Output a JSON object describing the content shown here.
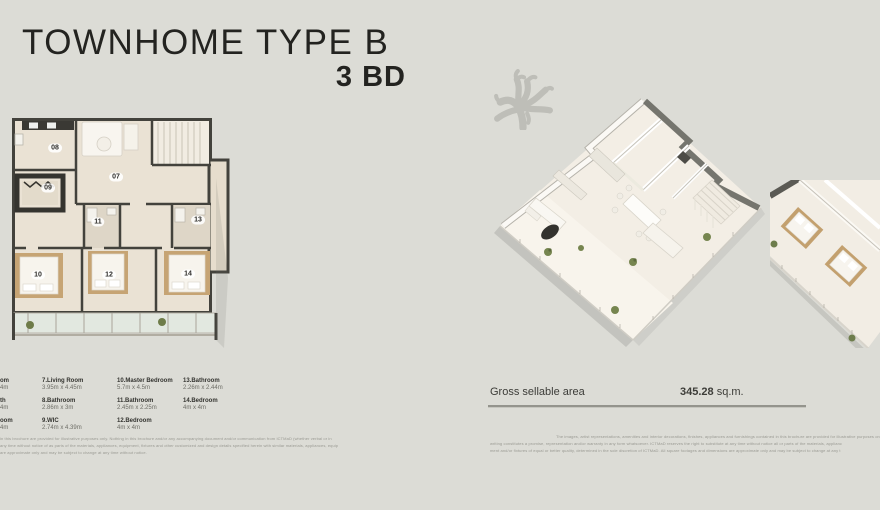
{
  "title": {
    "line1": "TOWNHOME TYPE B",
    "line2": "3 BD"
  },
  "plan2d": {
    "labels": [
      {
        "n": "08",
        "x": 43,
        "y": 30
      },
      {
        "n": "07",
        "x": 104,
        "y": 59
      },
      {
        "n": "09",
        "x": 36,
        "y": 70
      },
      {
        "n": "11",
        "x": 86,
        "y": 104
      },
      {
        "n": "13",
        "x": 186,
        "y": 102
      },
      {
        "n": "10",
        "x": 26,
        "y": 157
      },
      {
        "n": "12",
        "x": 97,
        "y": 157
      },
      {
        "n": "14",
        "x": 176,
        "y": 156
      }
    ]
  },
  "legend": {
    "col0": [
      {
        "name": "om",
        "dims": "4m"
      },
      {
        "name": "th",
        "dims": "4m"
      },
      {
        "name": "oom",
        "dims": "4m"
      }
    ],
    "col1": [
      {
        "name": "7.Living Room",
        "dims": "3.95m x 4.45m"
      },
      {
        "name": "8.Bathroom",
        "dims": "2.86m x 3m"
      },
      {
        "name": "9.WIC",
        "dims": "2.74m x 4.39m"
      }
    ],
    "col2": [
      {
        "name": "10.Master Bedroom",
        "dims": "5.7m x 4.5m"
      },
      {
        "name": "11.Bathroom",
        "dims": "2.45m x 2.25m"
      },
      {
        "name": "12.Bedroom",
        "dims": "4m x 4m"
      }
    ],
    "col3": [
      {
        "name": "13.Bathroom",
        "dims": "2.26m x 2.44m"
      },
      {
        "name": "14.Bedroom",
        "dims": "4m x 4m"
      }
    ]
  },
  "area": {
    "label": "Gross sellable area",
    "value": "345.28",
    "unit": "sq.m."
  },
  "disclaimer_left": [
    "in this brochure are provided for illustrative purposes only. Nothing in this brochure and/or any accompanying document and/or communication from ICTMaD (whether verbal or in",
    "any time without notice of as parts of the materials, appliances, equipment, fixtures and other customized and design details specified herein with similar materials, appliances, equip",
    "are approximate only and may be subject to change at any time without notice."
  ],
  "disclaimer_right": [
    "The images, artist representations, amenities and interior decorations, finishes, appliances and furnishings contained in this brochure are provided for illustrative purposes only. Nothin",
    "writing constitutes a promise, representation and/or warranty in any form whatsoever. ICTMaD reserves the right to substitute at any time without notice all or parts of the materials, applianc",
    "ment and/or fixtures of equal or better quality, determined in the sole discretion of ICTMaD. All square footages and dimensions are approximate only and may be subject to change at any t"
  ],
  "colors": {
    "background": "#dcdcd6",
    "ink": "#232320",
    "wall": "#43423c",
    "floor": "#eae2d4",
    "bed": "#c6a474",
    "balcony": "#e2e8e0",
    "coral": "#b7b7b1"
  }
}
